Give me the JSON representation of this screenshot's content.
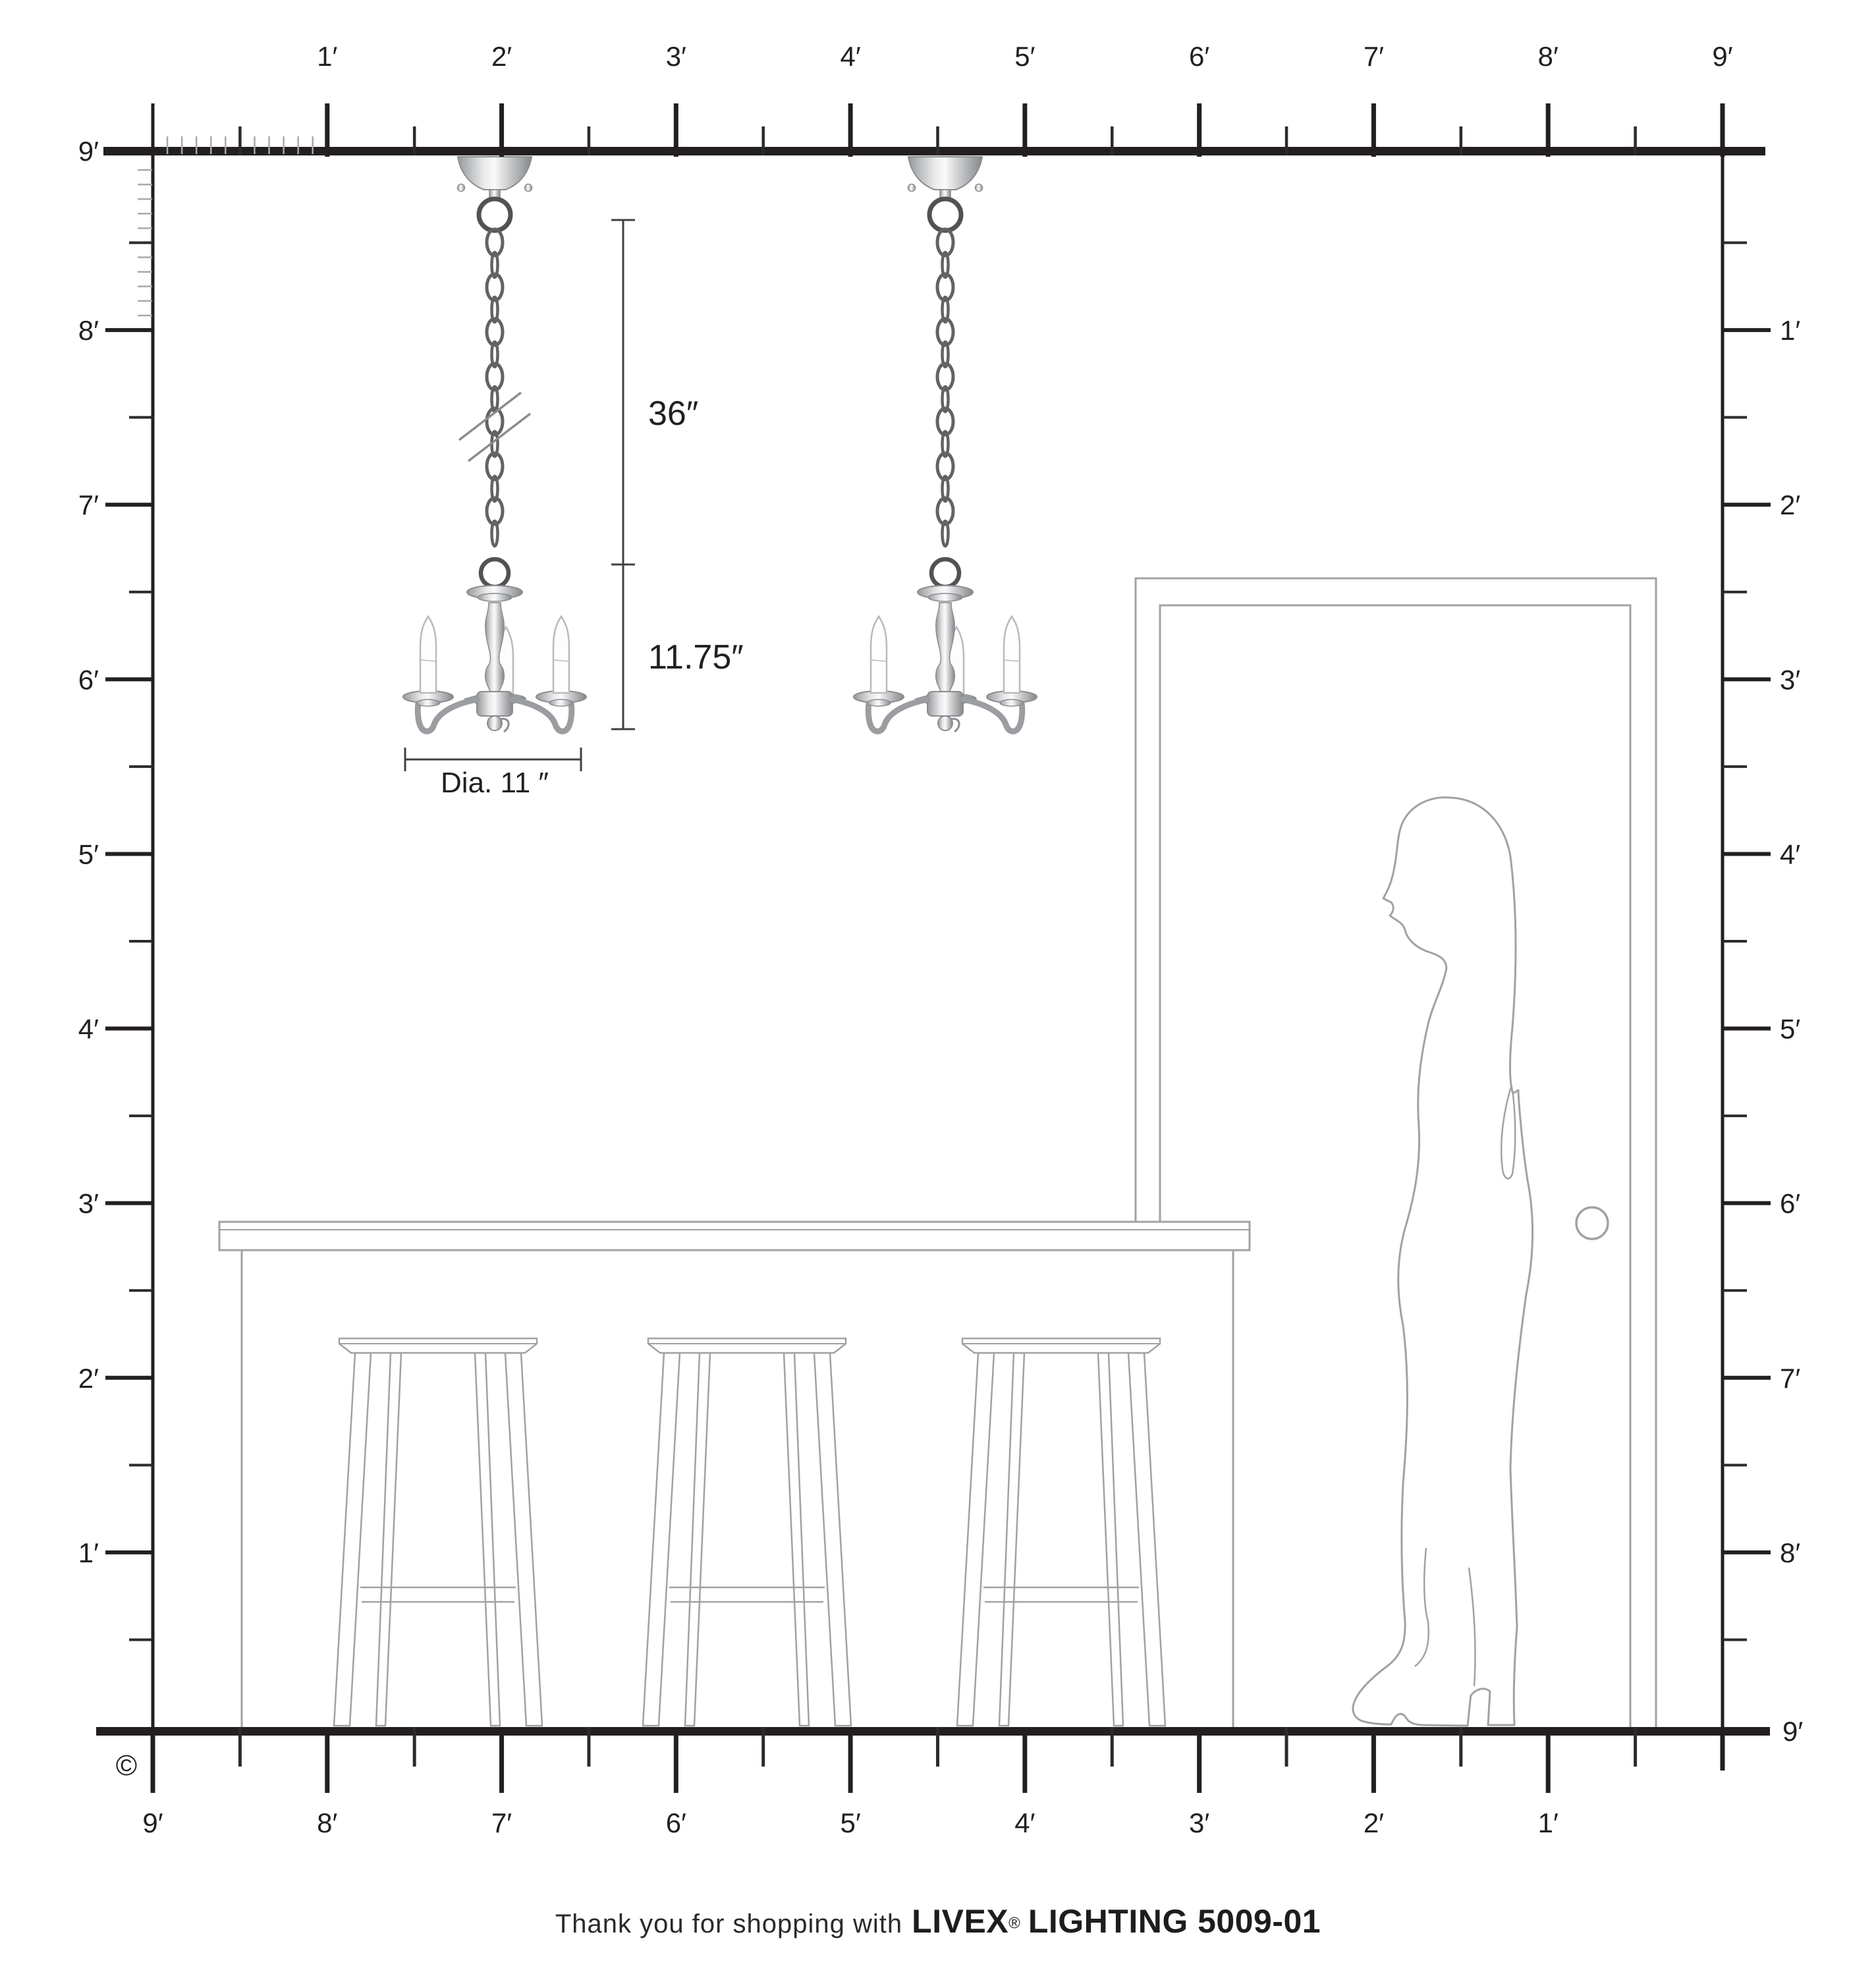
{
  "rulers": {
    "top": [
      "1′",
      "2′",
      "3′",
      "4′",
      "5′",
      "6′",
      "7′",
      "8′",
      "9′"
    ],
    "left_ceiling": "9′",
    "left": [
      "8′",
      "7′",
      "6′",
      "5′",
      "4′",
      "3′",
      "2′",
      "1′"
    ],
    "right": [
      "1′",
      "2′",
      "3′",
      "4′",
      "5′",
      "6′",
      "7′",
      "8′"
    ],
    "right_floor": "9′",
    "bottom": [
      "9′",
      "8′",
      "7′",
      "6′",
      "5′",
      "4′",
      "3′",
      "2′",
      "1′"
    ]
  },
  "dimensions": {
    "chain_drop": "36″",
    "fixture_height": "11.75″",
    "fixture_diameter": "Dia. 11 ″"
  },
  "copyright": "©",
  "footer": {
    "prefix": "Thank you for shopping with",
    "brand": "LIVEX",
    "registered": "®",
    "suffix": "LIGHTING 5009-01"
  },
  "colors": {
    "ruler": "#231f20",
    "tick_half": "#2b2b2d",
    "tick_inch": "#a7a9ac",
    "text": "#231f20",
    "outline": "#a0a2a5",
    "dimension": "#414042",
    "chain": "#616365",
    "ring": "#515254",
    "metal_edge": "#8a8c8f",
    "candle_fill": "#fdfdfd",
    "candle_edge": "#b8babc"
  }
}
